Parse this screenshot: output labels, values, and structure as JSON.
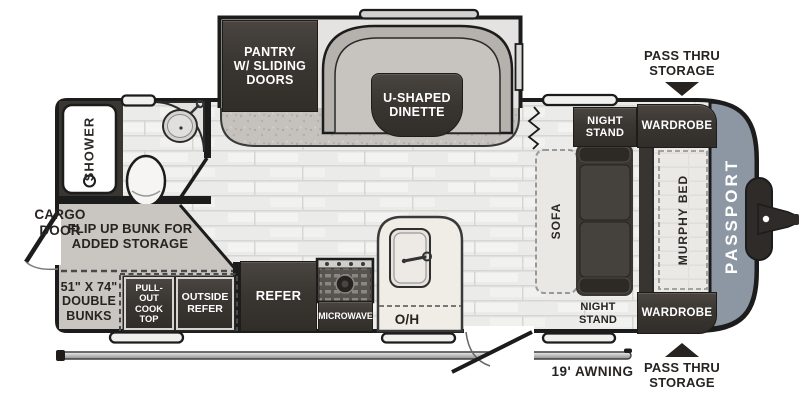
{
  "colors": {
    "dark_fixture": "#3a3632",
    "front_cap": "#8d97a4",
    "floor": "#ebebe9",
    "bunk_gray": "#c9c5c1",
    "counter_cream": "#f0ede6",
    "label_ink": "#262320"
  },
  "floorplan": {
    "brand": "PASSPORT",
    "exterior": {
      "pass_thru_top": "PASS THRU\nSTORAGE",
      "pass_thru_bottom": "PASS THRU\nSTORAGE",
      "cargo_door": "CARGO\nDOOR",
      "awning": "19' AWNING"
    },
    "slide_out": {
      "pantry": "PANTRY\nW/ SLIDING\nDOORS",
      "dinette": "U-SHAPED\nDINETTE"
    },
    "bath": {
      "shower": "SHOWER"
    },
    "bunks": {
      "flip_up": "FLIP UP BUNK FOR\nADDED STORAGE",
      "size": "51\" X 74\"\nDOUBLE\nBUNKS",
      "cook_top": "PULL-OUT\nCOOK\nTOP",
      "outside_refer": "OUTSIDE\nREFER"
    },
    "kitchen": {
      "refer": "REFER",
      "microwave": "MICROWAVE",
      "overhead": "O/H"
    },
    "bedroom": {
      "sofa": "SOFA",
      "murphy_bed": "MURPHY BED",
      "night_stand_top": "NIGHT\nSTAND",
      "night_stand_bottom": "NIGHT\nSTAND",
      "wardrobe_top": "WARDROBE",
      "wardrobe_bottom": "WARDROBE"
    }
  }
}
